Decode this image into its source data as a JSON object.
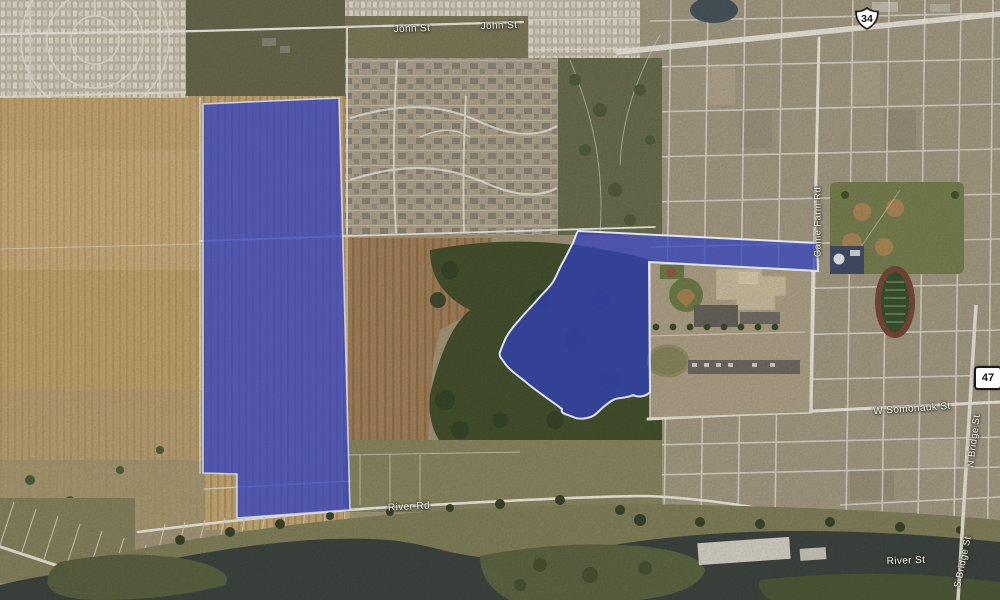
{
  "map": {
    "view_type": "satellite",
    "street_labels": [
      {
        "id": "john-st-w",
        "text": "John St"
      },
      {
        "id": "john-st-e",
        "text": "John St"
      },
      {
        "id": "game-farm-rd",
        "text": "Game Farm Rd"
      },
      {
        "id": "w-somonauk-st",
        "text": "W Somonauk St"
      },
      {
        "id": "n-bridge-st",
        "text": "N Bridge St"
      },
      {
        "id": "river-rd",
        "text": "River Rd"
      },
      {
        "id": "river-st",
        "text": "River St"
      },
      {
        "id": "s-bridge-st",
        "text": "S Bridge St"
      }
    ],
    "route_shields": [
      {
        "id": "us-34",
        "number": "34",
        "type": "us-route"
      },
      {
        "id": "il-47",
        "number": "47",
        "type": "state-route"
      }
    ],
    "highlighted_parcels": [
      {
        "id": "west-parcel",
        "description": "large rectangular farmland parcel west of subdivision"
      },
      {
        "id": "east-parcel",
        "description": "irregular wooded parcel wrapping school campus"
      }
    ],
    "colors": {
      "parcel_highlight": "#3040c0",
      "parcel_outline": "#e6ebf6",
      "water": "#3f4742",
      "farmland": "#c9ad7a",
      "woodland": "#47532f",
      "road": "#f1eee4"
    }
  }
}
